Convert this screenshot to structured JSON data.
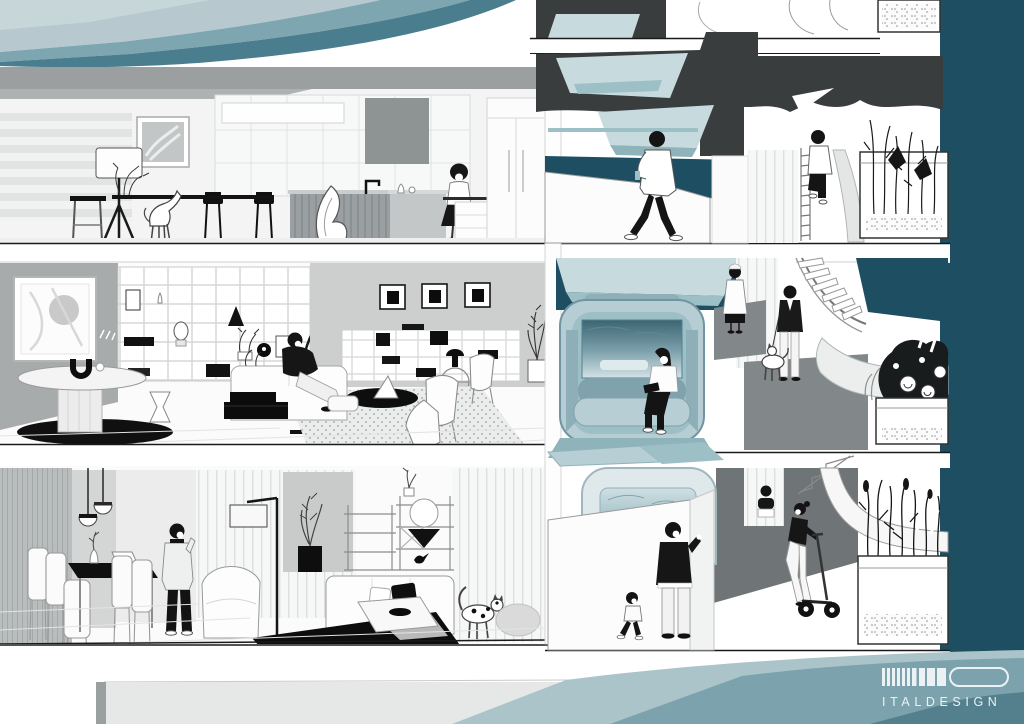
{
  "brand": {
    "logo_text": "ITALDESIGN",
    "logo_icon": "italdesign-bars-icon"
  },
  "palette": {
    "dark_teal": "#1d4e61",
    "pale_teal": "#c7dbdf",
    "teal_2": "#9dbfc6",
    "teal_3": "#8fb3ba",
    "vehicle_teal": "#b5cdd3",
    "vehicle_frame_teal": "#6f95a1",
    "seat_teal": "#8fafb8",
    "seat_light_teal": "#b7cfd4",
    "dark_mass_gray": "#3a3d3e",
    "ceiling_gray": "#9b9fa0",
    "wall_gray": "#cdcfcf",
    "plaza_gray": "#82888a",
    "plaza_dark_gray": "#6f7577",
    "ink": "#161616",
    "paper": "#ffffff",
    "sw_top_light": "#b7c9ce",
    "sw_top_mid": "#7ea6b1",
    "sw_top_deep": "#4a7d8e",
    "sw_bot_light": "#aac4ca",
    "sw_bot_mid": "#7ca2ad",
    "sw_bot_deep": "#547f8c",
    "logo_white": "#ecf2f3"
  },
  "scene": {
    "type": "cutaway-building-section-illustration",
    "floors": [
      {
        "id": "top-floor",
        "room": "kitchen",
        "figures": [
          "woman-standing"
        ],
        "pets": [
          "greyhound-dog"
        ],
        "objects": [
          "striped-wallpaper",
          "floor-lamp",
          "bar-stool",
          "wall-art",
          "counter-plants",
          "black-counter-stools",
          "kitchen-island",
          "sculptural-chair",
          "faucet",
          "range-hood",
          "wall-cabinets",
          "tall-cabinets"
        ]
      },
      {
        "id": "middle-floor",
        "room": "living-room",
        "figures": [
          "man-sitting-on-sofa"
        ],
        "objects": [
          "abstract-wall-art",
          "oval-pedestal-table",
          "arch-sculpture",
          "black-oval-rug",
          "grid-bookshelf",
          "hourglass-stool",
          "arc-floor-lamp",
          "sofa",
          "stacked-black-tables",
          "framed-prints",
          "low-grid-shelf",
          "mushroom-table-lamp",
          "wire-side-table",
          "round-black-table",
          "lounge-chairs",
          "speckled-rug",
          "potted-plant"
        ]
      },
      {
        "id": "lower-floor",
        "room": "dining-living-room",
        "figures": [
          "man-on-phone"
        ],
        "pets": [
          "spotted-cat"
        ],
        "objects": [
          "hatched-wall",
          "pendant-lamps",
          "dining-table",
          "dining-chairs",
          "vase-with-sprig",
          "laptop",
          "armchair",
          "floor-lamp",
          "potted-plant",
          "etagere-shelves",
          "circle-ornament",
          "bird-figurine",
          "sofa",
          "black-pillow",
          "coffee-table",
          "black-bowl",
          "black-rug",
          "gray-pouf",
          "striped-curtain-wall"
        ]
      }
    ],
    "circulation": [
      {
        "id": "upper-landing",
        "figures": [
          "man-walking-with-phone",
          "person-climbing-stairs"
        ],
        "objects": [
          "car-lift-bay",
          "skylight-planes",
          "parapet-wall",
          "ladder-stair",
          "curved-stair-wall",
          "planter-box",
          "rooftop-planter"
        ]
      },
      {
        "id": "mid-landing",
        "figures": [
          "woman-reading-in-pod",
          "woman-in-white-coat",
          "man-walking-dog"
        ],
        "pets": [
          "leashed-dog"
        ],
        "objects": [
          "autonomous-pod-vehicle",
          "pod-bench-seat",
          "pod-window",
          "floor-deck-panels",
          "walkway-ramp",
          "spiral-staircase",
          "curved-ramp-wall",
          "flower-planter",
          "peony-flowers"
        ]
      },
      {
        "id": "street-level",
        "figures": [
          "father-waving",
          "toddler-walking",
          "woman-on-e-scooter",
          "person-behind-parapet"
        ],
        "objects": [
          "pod-vehicle-rear",
          "parapet-wall",
          "plaza-ground",
          "stair-flight",
          "curved-ramp-ribbon",
          "grass-planter",
          "wind-slashes"
        ]
      }
    ],
    "decor": {
      "top_swoosh_bands": 3,
      "bottom_swoosh_bands": 3,
      "right_backdrop": "dark-teal-column"
    }
  }
}
